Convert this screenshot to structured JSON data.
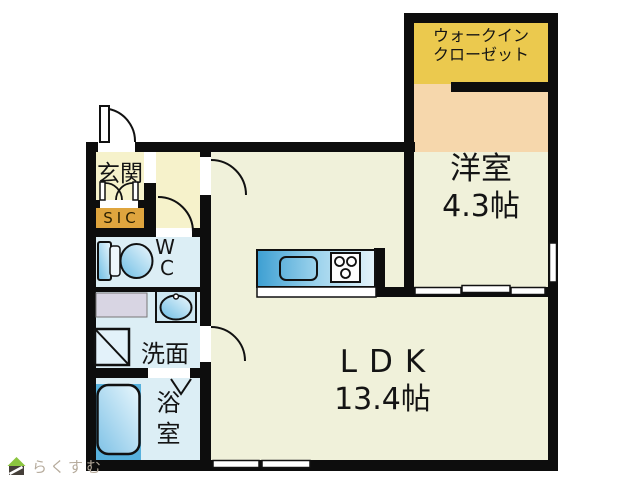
{
  "plan": {
    "type": "floor-plan",
    "rooms": {
      "wic": {
        "line1": "ウォークイン",
        "line2": "クローゼット"
      },
      "yoshitsu": {
        "name": "洋室",
        "size": "4.3帖"
      },
      "ldk": {
        "name": "LDK",
        "size": "13.4帖"
      },
      "genkan": {
        "name": "玄関"
      },
      "sic": {
        "name": "SIC"
      },
      "wc": {
        "line1": "W",
        "line2": "C"
      },
      "senmen": {
        "name": "洗面"
      },
      "yokushitsu": {
        "name": "浴室"
      }
    },
    "fixtures": [
      "entry-door-icon",
      "sic-double-door-icon",
      "ldk-door-icon",
      "wc-door-icon",
      "senmen-door-icon",
      "bath-folding-door-icon",
      "toilet-icon",
      "wash-basin-icon",
      "washer-pan-icon",
      "counter-icon",
      "bathtub-icon",
      "kitchen-counter-icon",
      "kitchen-sink-icon",
      "stove-icon",
      "sliding-door-icon",
      "window-icon"
    ],
    "colors": {
      "wall": "#0d0d0d",
      "genkan_floor": "#f6f2cb",
      "sic_badge": "#dfa53e",
      "wic_floor": "#ebc94e",
      "yoshitsu_floor": "#f6d7ac",
      "ldk_floor": "#f0f1da",
      "wet_floor": "#dceef5",
      "fixture_blue": "#57b1dd",
      "counter_gray": "#d8d5e3"
    }
  },
  "logo": {
    "text": "らくすむ",
    "roof_color": "#8bc53f"
  }
}
